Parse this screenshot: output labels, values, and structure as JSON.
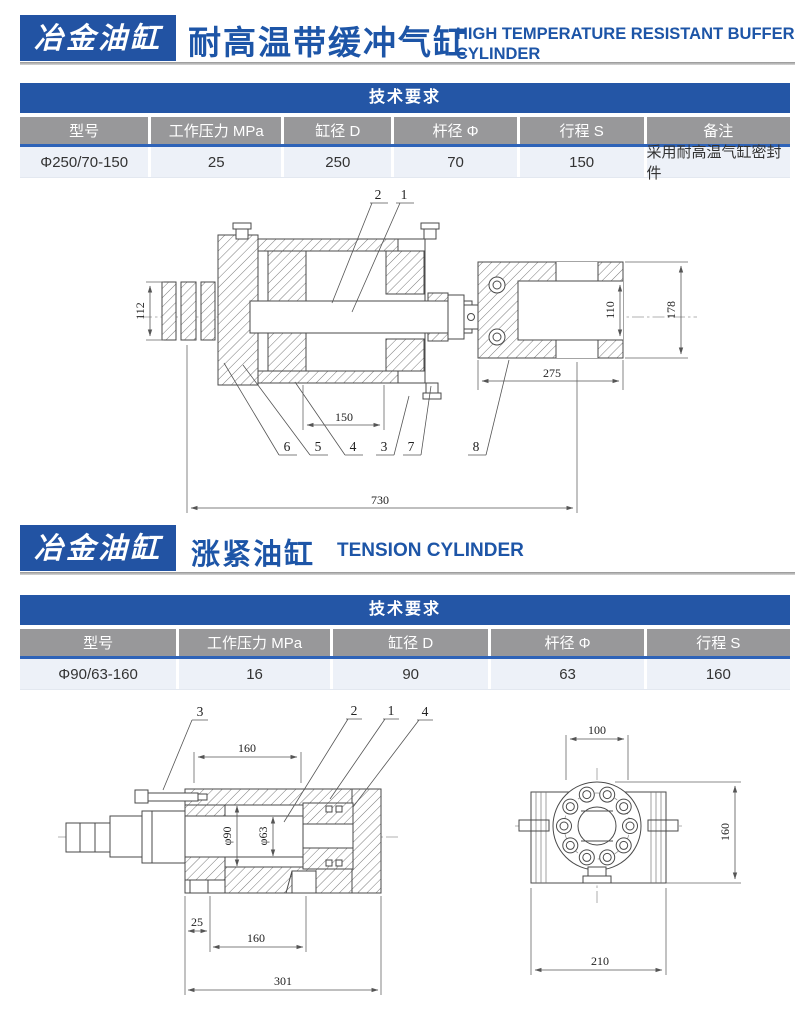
{
  "colors": {
    "accent_blue": "#2253a3",
    "title_blue": "#1d55a7",
    "table_bar_blue": "#2456a6",
    "header_gray": "#98989a",
    "divider_blue": "#2e63b8",
    "row_bg": "#edf1f8"
  },
  "sections": [
    {
      "badge": "冶金油缸",
      "title_cn": "耐高温带缓冲气缸",
      "title_en": "HIGH TEMPERATURE RESISTANT BUFFER CYLINDER",
      "table": {
        "title": "技术要求",
        "columns": [
          "型号",
          "工作压力 MPa",
          "缸径 D",
          "杆径 Φ",
          "行程 S",
          "备注"
        ],
        "row": [
          "Φ250/70-150",
          "25",
          "250",
          "70",
          "150",
          "采用耐高温气缸密封件"
        ]
      },
      "drawing": {
        "labels_top": [
          "2",
          "1"
        ],
        "labels_bottom": [
          "6",
          "5",
          "4",
          "3",
          "7",
          "8"
        ],
        "dims": {
          "boss_od": "112",
          "slot_height": "110",
          "block_height": "178",
          "block_length": "275",
          "stroke_length": "150",
          "overall_length": "730"
        }
      }
    },
    {
      "badge": "冶金油缸",
      "title_cn": "涨紧油缸",
      "title_en": "TENSION CYLINDER",
      "table": {
        "title": "技术要求",
        "columns": [
          "型号",
          "工作压力 MPa",
          "缸径 D",
          "杆径 Φ",
          "行程 S"
        ],
        "row": [
          "Φ90/63-160",
          "16",
          "90",
          "63",
          "160"
        ]
      },
      "drawing_side": {
        "labels": [
          "3",
          "2",
          "1",
          "4"
        ],
        "dims": {
          "top_length": "160",
          "bore": "φ90",
          "rod": "φ63",
          "foot_offset": "25",
          "foot_spacing": "160",
          "overall_length": "301"
        }
      },
      "drawing_end": {
        "dims": {
          "top_width": "100",
          "height": "160",
          "width": "210"
        }
      }
    }
  ]
}
